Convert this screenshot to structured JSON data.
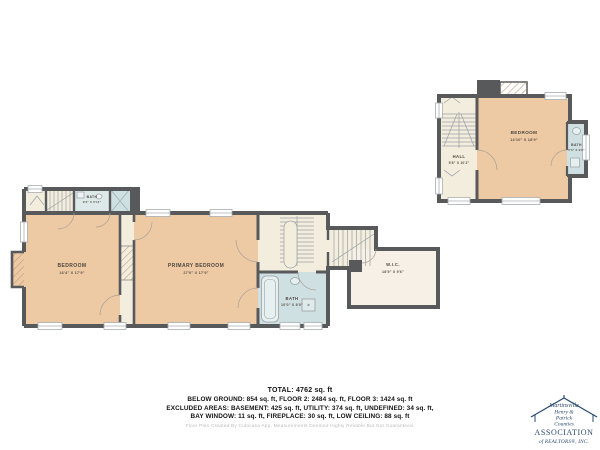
{
  "colors": {
    "wall": "#58595b",
    "room": "#edc9a4",
    "bath": "#cfe0e3",
    "bath_pale": "#dde9e9",
    "hall": "#f3edde",
    "wic": "#f7f0e6",
    "logo": "#2c4a70"
  },
  "plan": {
    "floor2": {
      "bedroom": {
        "name": "BEDROOM",
        "dims": "16'4\" X 17'9\""
      },
      "primary": {
        "name": "PRIMARY BEDROOM",
        "dims": "27'0\" X 17'9\""
      },
      "bath_small": {
        "name": "BATH",
        "dims": "9'3\" X 5'11\""
      },
      "bath": {
        "name": "BATH",
        "dims": "10'0\" X 8'0\""
      },
      "wic": {
        "name": "W.I.C.",
        "dims": "18'5\" X 9'6\""
      }
    },
    "floor3": {
      "bedroom": {
        "name": "BEDROOM",
        "dims": "14'10\" X 18'9\""
      },
      "hall": {
        "name": "HALL",
        "dims": "5'8\" X 10'2\""
      },
      "bath": {
        "name": "BATH",
        "dims": "5'6\" X 9'8\""
      }
    }
  },
  "summary": {
    "total": "TOTAL: 4762 sq. ft",
    "line1": "BELOW GROUND: 854 sq. ft, FLOOR 2: 2484 sq. ft, FLOOR 3: 1424 sq. ft",
    "line2": "EXCLUDED AREAS: BASEMENT: 425 sq. ft, UTILITY: 374 sq. ft, UNDEFINED: 34 sq. ft,",
    "line3": "BAY WINDOW: 11 sq. ft, FIREPLACE: 30 sq. ft, LOW CEILING: 88 sq. ft",
    "disclaimer": "Floor Plan Created By Cubicasa App. Measurements Deemed Highly Reliable But Not Guaranteed."
  },
  "logo": {
    "name1": "Martinsville",
    "name2": "Henry &",
    "name3": "Patrick",
    "name4": "Counties",
    "org": "ASSOCIATION",
    "sub": "of REALTORS®, INC."
  }
}
